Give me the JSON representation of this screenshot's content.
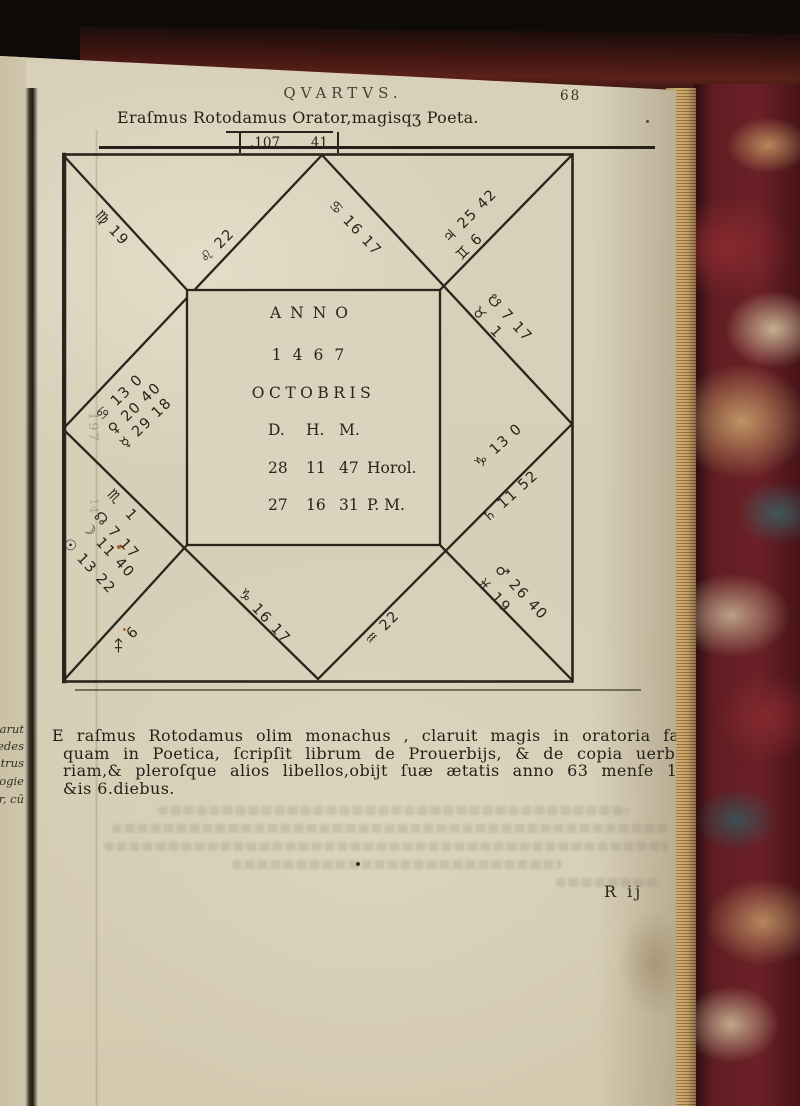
{
  "header": {
    "running_title": "QVARTVS.",
    "page_number": "68"
  },
  "title_line": "Eraſmus Rotodamus Orator,magisqʒ Poeta.",
  "figure_box": {
    "left_value": ".107",
    "right_value": "41"
  },
  "chart": {
    "type": "renaissance-square-horoscope",
    "center": {
      "anno_label": "ANNO",
      "year": "1467",
      "month": "OCTOBRIS",
      "cols_header": [
        "D.",
        "H.",
        "M."
      ],
      "hours_row": [
        "28",
        "11",
        "47",
        "Horol."
      ],
      "pm_row": [
        "27",
        "16",
        "31",
        "P. M."
      ]
    },
    "houses": [
      {
        "name": "cusp-virgo-19",
        "text": "♍ 19",
        "x": 97,
        "y": 206,
        "rot": 47
      },
      {
        "name": "cusp-leo-22",
        "text": "♌ 22",
        "x": 203,
        "y": 254,
        "rot": -45
      },
      {
        "name": "cusp-cancer-16-17",
        "text": "♋ 16 17",
        "x": 331,
        "y": 196,
        "rot": 47
      },
      {
        "name": "planet-jupiter-25-42",
        "text": "♃ 25 42",
        "x": 446,
        "y": 234,
        "rot": -45
      },
      {
        "name": "cusp-gemini-6",
        "text": "♊ 6",
        "x": 459,
        "y": 251,
        "rot": -45
      },
      {
        "name": "node-south-7-17",
        "text": "☋ 7 17",
        "x": 489,
        "y": 290,
        "rot": 47
      },
      {
        "name": "cusp-taurus-1",
        "text": "♉  1",
        "x": 474,
        "y": 302,
        "rot": 47
      },
      {
        "name": "cusp-capricorn-13-0",
        "text": "♑ 13 0",
        "x": 477,
        "y": 459,
        "rot": -42
      },
      {
        "name": "planet-saturn-11-52",
        "text": "♄ 11 52",
        "x": 485,
        "y": 513,
        "rot": -42
      },
      {
        "name": "planet-mars-26-40",
        "text": "♂ 26 40",
        "x": 497,
        "y": 560,
        "rot": 47
      },
      {
        "name": "cusp-pisces-19",
        "text": "♓ 19",
        "x": 479,
        "y": 573,
        "rot": 47
      },
      {
        "name": "cusp-aquarius-22",
        "text": "♒ 22",
        "x": 368,
        "y": 636,
        "rot": -45
      },
      {
        "name": "cusp-capricorn-16-17",
        "text": "♑ 16 17",
        "x": 240,
        "y": 584,
        "rot": 47
      },
      {
        "name": "cusp-sagittarius-6",
        "text": "♐ 6",
        "x": 115,
        "y": 644,
        "rot": -45
      },
      {
        "name": "cusp-scorpio-1",
        "text": "♏  1",
        "x": 109,
        "y": 485,
        "rot": 47
      },
      {
        "name": "node-north-7-17",
        "text": "☊ 7 17",
        "x": 96,
        "y": 507,
        "rot": 47
      },
      {
        "name": "planet-moon-11-40",
        "text": "☽ 11 40",
        "x": 84,
        "y": 518,
        "rot": 47
      },
      {
        "name": "planet-sun-13-22",
        "text": "☉ 13 22",
        "x": 65,
        "y": 534,
        "rot": 47
      },
      {
        "name": "cusp-cancer-13-0",
        "text": "♋ 13 0",
        "x": 99,
        "y": 411,
        "rot": -44
      },
      {
        "name": "planet-venus-20-40",
        "text": "♀ 20 40",
        "x": 111,
        "y": 425,
        "rot": -44
      },
      {
        "name": "planet-mercury-29-18",
        "text": "☿ 29 18",
        "x": 123,
        "y": 439,
        "rot": -44
      }
    ]
  },
  "paragraph": {
    "lines": [
      "E raſmus Rotodamus olim monachus , claruit magis in oratoria facultate,",
      "quam in Poetica, ſcripſit librum de Prouerbijs, & de copia uerborū Mo",
      "riam,& pleroſque alios libellos,obijt ſuæ ætatis anno 63 menſe 11. didu",
      "&is 6.diebus."
    ]
  },
  "margin_fragments": [
    {
      "text": "narut,",
      "y": 722
    },
    {
      "text": "at edes",
      "y": 739
    },
    {
      "text": "udtrus.",
      "y": 756
    },
    {
      "text": "ogie, &",
      "y": 774
    },
    {
      "text": "er, cū",
      "y": 792
    }
  ],
  "ghost_margin_number": "197",
  "ghost_margin_number2": "14",
  "signature_mark": "R ij",
  "colors": {
    "paper": "#d7cfb7",
    "ink": "#2a231b",
    "marble_maroon": "#6b2127",
    "marble_cream": "#d8c9a4",
    "marble_teal": "#39676a",
    "fore_edge_tan": "#c09a5c",
    "background": "#0d0a08"
  }
}
